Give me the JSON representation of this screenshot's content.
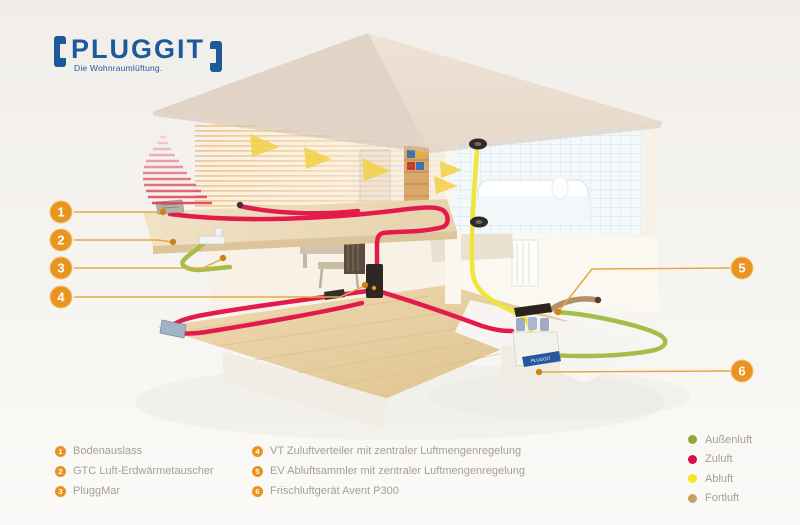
{
  "logo": {
    "name": "PLUGGIT",
    "tagline": "Die Wohnraumlüftung."
  },
  "callouts": [
    {
      "num": "1",
      "label": "Bodenauslass"
    },
    {
      "num": "2",
      "label": "GTC Luft-Erdwärmetauscher"
    },
    {
      "num": "3",
      "label": "PluggMar"
    },
    {
      "num": "4",
      "label": "VT Zuluftverteiler mit zentraler Luftmengenregelung"
    },
    {
      "num": "5",
      "label": "EV Abluftsammler mit zentraler Luftmengenregelung"
    },
    {
      "num": "6",
      "label": "Frischluftgerät Avent P300"
    }
  ],
  "air_legend": [
    {
      "label": "Außenluft",
      "color": "#93a637"
    },
    {
      "label": "Zuluft",
      "color": "#d60f47"
    },
    {
      "label": "Abluft",
      "color": "#f2e71e"
    },
    {
      "label": "Fortluft",
      "color": "#c5a263"
    }
  ],
  "diagram": {
    "unit_label": "PLUGGIT"
  },
  "colors": {
    "callout_orange": "#e8941f",
    "logo_blue": "#1d5a9c",
    "zuluft_duct": "#e31b4d",
    "abluft_duct": "#efe63a",
    "aussenluft_duct": "#a5be4b",
    "fortluft_duct": "#b2906a"
  }
}
